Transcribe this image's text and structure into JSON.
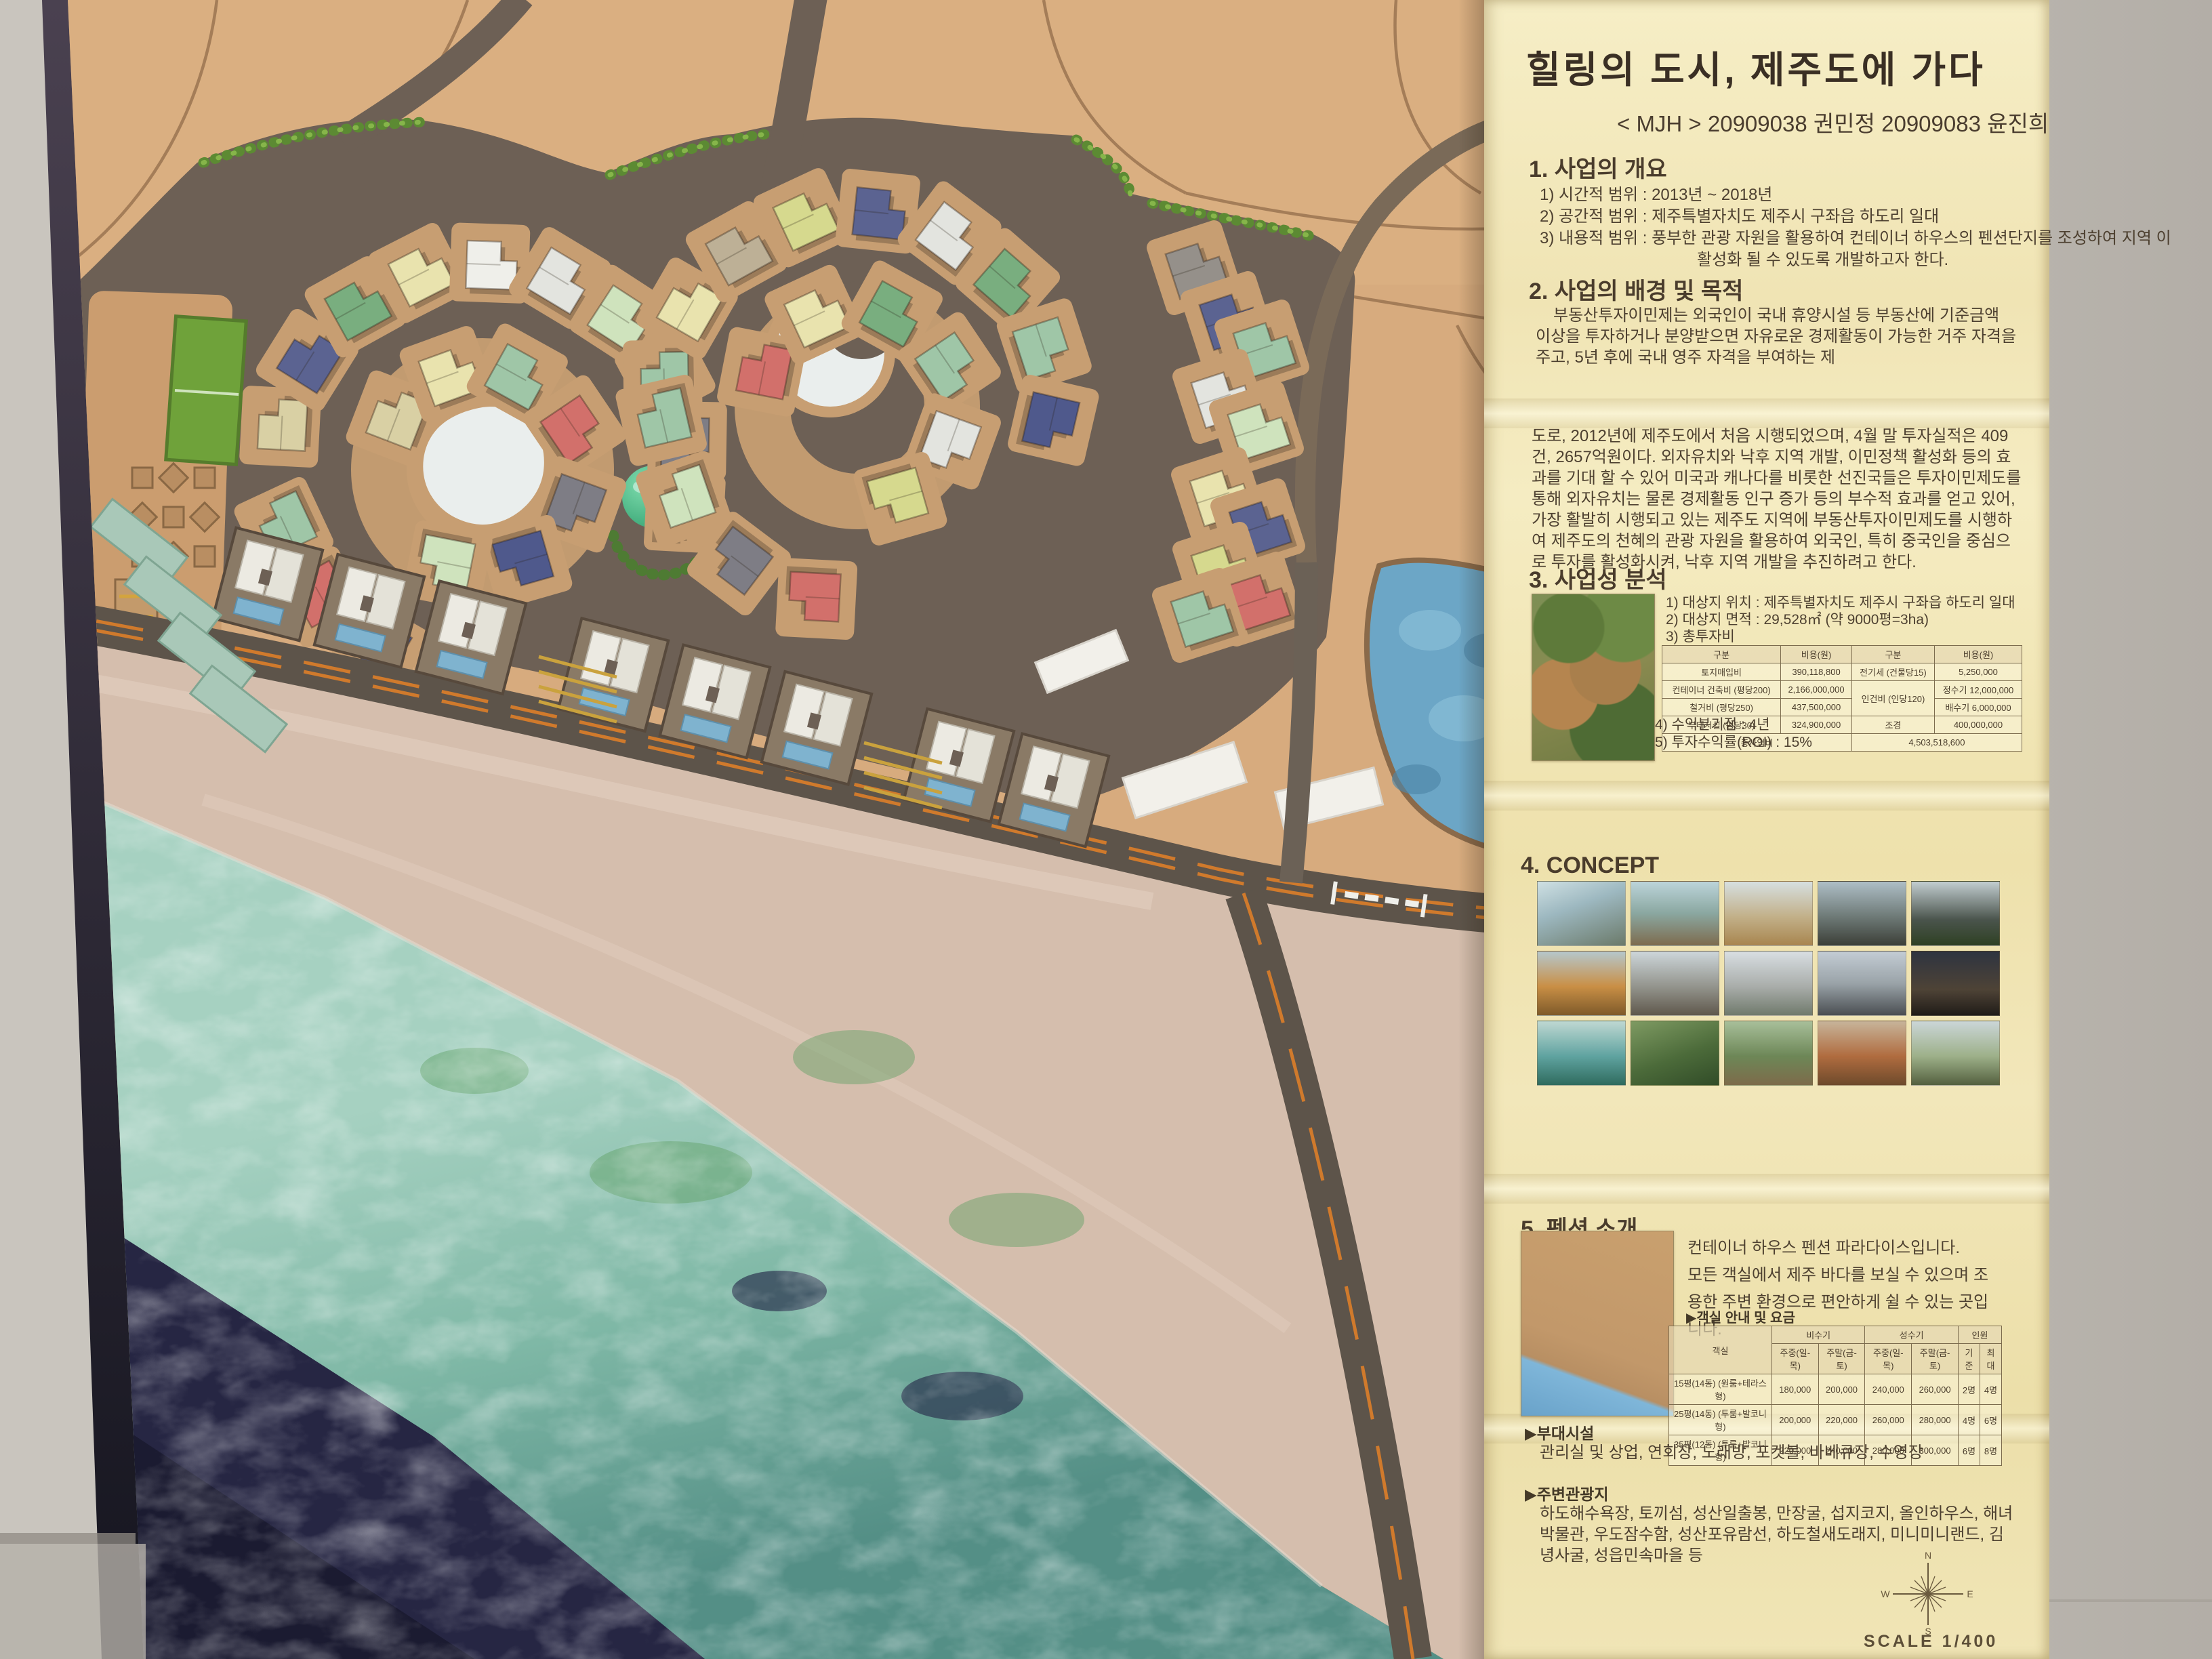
{
  "panel": {
    "title": "힐링의 도시, 제주도에 가다",
    "subtitle": "< MJH > 20909038 권민정 20909083 윤진희",
    "section1": {
      "heading": "1. 사업의 개요",
      "items": [
        "1) 시간적 범위 : 2013년 ~ 2018년",
        "2) 공간적 범위 : 제주특별자치도 제주시 구좌읍 하도리 일대",
        "3) 내용적 범위 : 풍부한 관광 자원을 활용하여 컨테이너 하우스의 펜션단지를 조성하여 지역 이 활성화 될 수 있도록 개발하고자 한다."
      ]
    },
    "section2": {
      "heading": "2. 사업의 배경 및 목적",
      "paragraph1": "부동산투자이민제는 외국인이 국내 휴양시설 등 부동산에 기준금액 이상을 투자하거나 분양받으면 자유로운 경제활동이 가능한 거주 자격을 주고, 5년 후에 국내 영주 자격을 부여하는 제",
      "paragraph2": "도로, 2012년에 제주도에서 처음 시행되었으며, 4월 말 투자실적은 409건, 2657억원이다. 외자유치와 낙후 지역 개발, 이민정책 활성화 등의 효과를 기대 할 수 있어 미국과 캐나다를 비롯한 선진국들은 투자이민제도를 통해 외자유치는 물론 경제활동 인구 증가 등의 부수적 효과를 얻고 있어, 가장 활발히 시행되고 있는 제주도 지역에 부동산투자이민제도를 시행하여 제주도의 천혜의 관광 자원을 활용하여 외국인, 특히 중국인을 중심으로 투자를 활성화시켜, 낙후 지역 개발을 추진하려고 한다."
    },
    "section3": {
      "heading": "3. 사업성 분석",
      "items": [
        "1) 대상지 위치 : 제주특별자치도 제주시 구좌읍 하도리 일대",
        "2) 대상지 면적 : 29,528㎡ (약 9000평=3ha)",
        "3) 총투자비"
      ],
      "cost_table": {
        "headerRows": 1,
        "rows": [
          [
            "구분",
            "비용(원)",
            "구분",
            "비용(원)"
          ],
          [
            "토지매입비",
            "390,118,800",
            "전기세 (건물당15)",
            "5,250,000"
          ],
          [
            "컨테이너 건축비 (평당200)",
            "2,166,000,000",
            {
              "t": "인건비 (인당120)",
              "rs": 2
            },
            "정수기 12,000,000"
          ],
          [
            "철거비 (평당250)",
            "437,500,000",
            "배수기 6,000,000"
          ],
          [
            "부대시설 (평당30)",
            "324,900,000",
            "조경",
            "400,000,000"
          ],
          [
            {
              "t": "총사업비",
              "cs": 2
            },
            {
              "t": "4,503,518,600",
              "cs": 2
            }
          ]
        ]
      },
      "items2": [
        "4) 수익분기점 : 4년",
        "5) 투자수익률(ROI) : 15%"
      ]
    },
    "section4": {
      "heading": "4. CONCEPT"
    },
    "section5": {
      "heading": "5. 펜션 소개",
      "intro1": "컨테이너 하우스 펜션 파라다이스입니다.",
      "intro2": "모든 객실에서 제주 바다를 보실 수 있으며 조용한 주변 환경으로 편안하게 쉴 수 있는 곳입니다.",
      "room_table_label": "▶객실 안내 및 요금",
      "price_table": {
        "headerRows": 2,
        "rows": [
          [
            {
              "t": "객실",
              "rs": 2
            },
            {
              "t": "비수기",
              "cs": 2
            },
            {
              "t": "성수기",
              "cs": 2
            },
            {
              "t": "인원",
              "cs": 2
            }
          ],
          [
            "주중(일-목)",
            "주말(금-토)",
            "주중(일-목)",
            "주말(금-토)",
            "기준",
            "최대"
          ],
          [
            "15평(14동) (원룸+테라스형)",
            "180,000",
            "200,000",
            "240,000",
            "260,000",
            "2명",
            "4명"
          ],
          [
            "25평(14동) (투룸+발코니형)",
            "200,000",
            "220,000",
            "260,000",
            "280,000",
            "4명",
            "6명"
          ],
          [
            "35평(12동) (투룸+발코니형)",
            "220,000",
            "240,000",
            "280,000",
            "300,000",
            "6명",
            "8명"
          ]
        ]
      }
    },
    "facilities": {
      "label": "▶부대시설",
      "text": "관리실 및 상업, 연회장, 노래방, 포켓볼, 바베큐장, 수영장"
    },
    "attractions": {
      "label": "▶주변관광지",
      "text": "하도해수욕장, 토끼섬, 성산일출봉, 만장굴, 섭지코지, 올인하우스, 해녀박물관, 우도잠수함, 성산포유람선, 하도철새도래지, 미니미니랜드, 김녕사굴, 성읍민속마을 등"
    },
    "compass": {
      "n": "N",
      "e": "E",
      "s": "S",
      "w": "W"
    },
    "scale_label": "SCALE 1/400"
  },
  "model": {
    "accent_colors": {
      "terrain": "#d7ab7e",
      "site": "#6d6055",
      "sand": "#d5bead",
      "ocean_shallow": "#a3cfc0",
      "ocean_deep": "#222240",
      "road_line_orange": "#d07a2c",
      "hedge_green": "#5c8a33",
      "pond_white": "#eaeeed",
      "dome_green": "#3fae7e",
      "pool_blue": "#7fb3cf"
    }
  }
}
